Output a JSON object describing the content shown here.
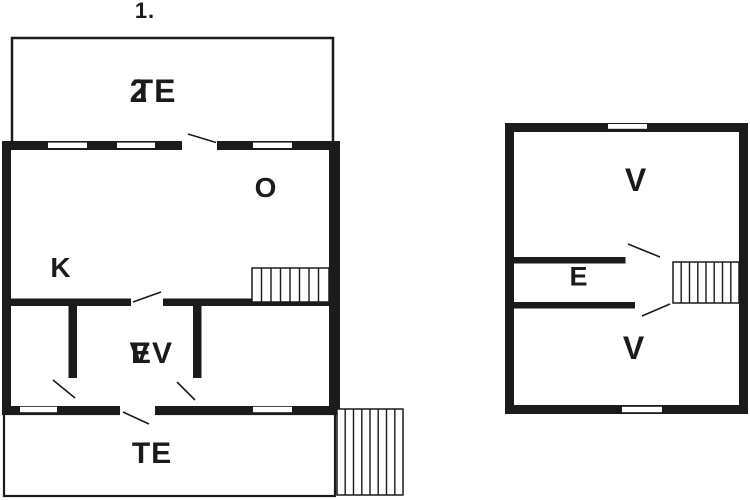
{
  "meta": {
    "floor_label": "1."
  },
  "colors": {
    "wall": "#1b1b1b",
    "background": "#ffffff"
  },
  "main_building": {
    "upper_terrace": {
      "label": "TE",
      "overlay": "2"
    },
    "living_room": {
      "label": "O"
    },
    "kitchen": {
      "label": "K"
    },
    "middle_room": {
      "label": "EV",
      "overlay": "V"
    },
    "lower_terrace": {
      "label": "TE"
    }
  },
  "annex": {
    "room_top": {
      "label": "V"
    },
    "hallway": {
      "label": "E"
    },
    "room_bottom": {
      "label": "V"
    }
  }
}
